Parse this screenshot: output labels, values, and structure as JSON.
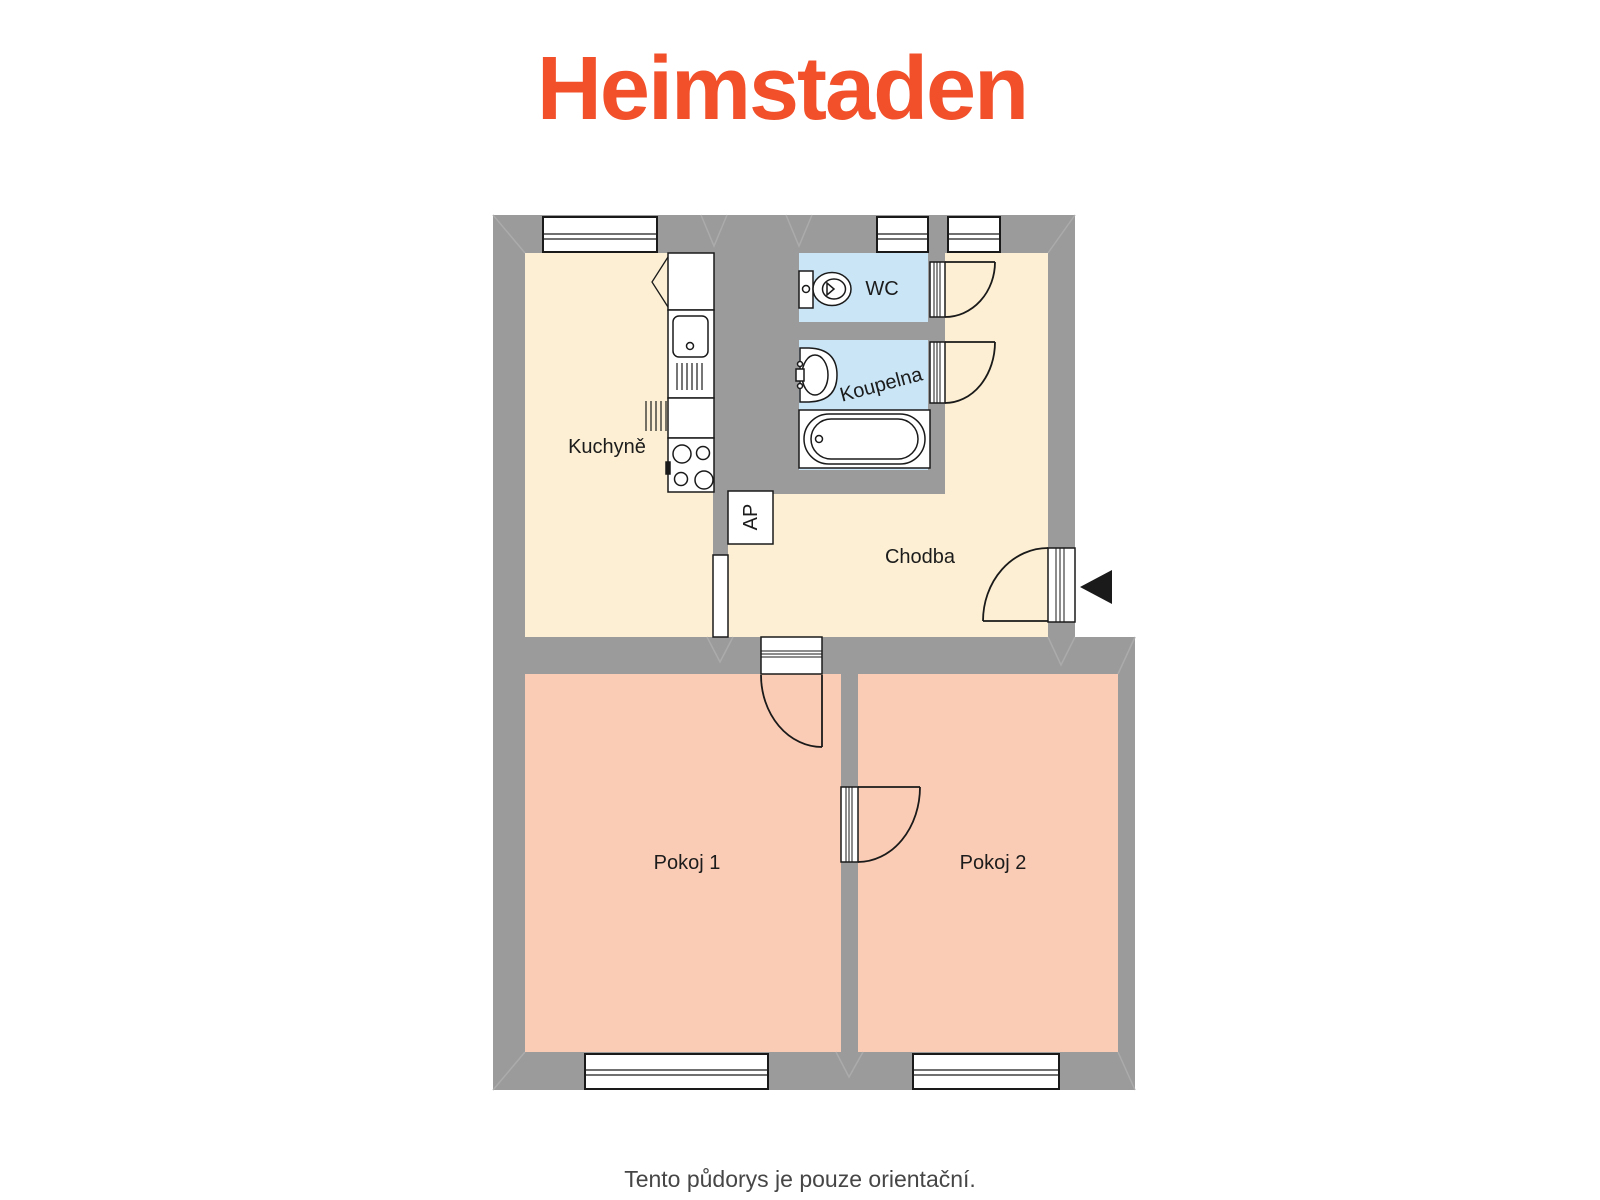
{
  "page": {
    "logo": "Heimstaden",
    "caption": "Tento půdorys je pouze orientační."
  },
  "floorplan": {
    "rooms": {
      "kitchen": {
        "label": "Kuchyně"
      },
      "wc": {
        "label": "WC"
      },
      "bathroom": {
        "label": "Koupelna"
      },
      "hallway": {
        "label": "Chodba"
      },
      "room1": {
        "label": "Pokoj 1"
      },
      "room2": {
        "label": "Pokoj 2"
      },
      "closet": {
        "label": "AP"
      }
    },
    "icons": {
      "entrance_arrow": "left-pointing-triangle"
    },
    "colors": {
      "wall": "#9b9b9b",
      "kitchen_hall_floor": "#fcefd3",
      "bath_floor": "#c9e5f6",
      "room_floor": "#fbccb5",
      "line": "#1a1a1a",
      "logo": "#f1502b",
      "caption_text": "#464646"
    }
  }
}
